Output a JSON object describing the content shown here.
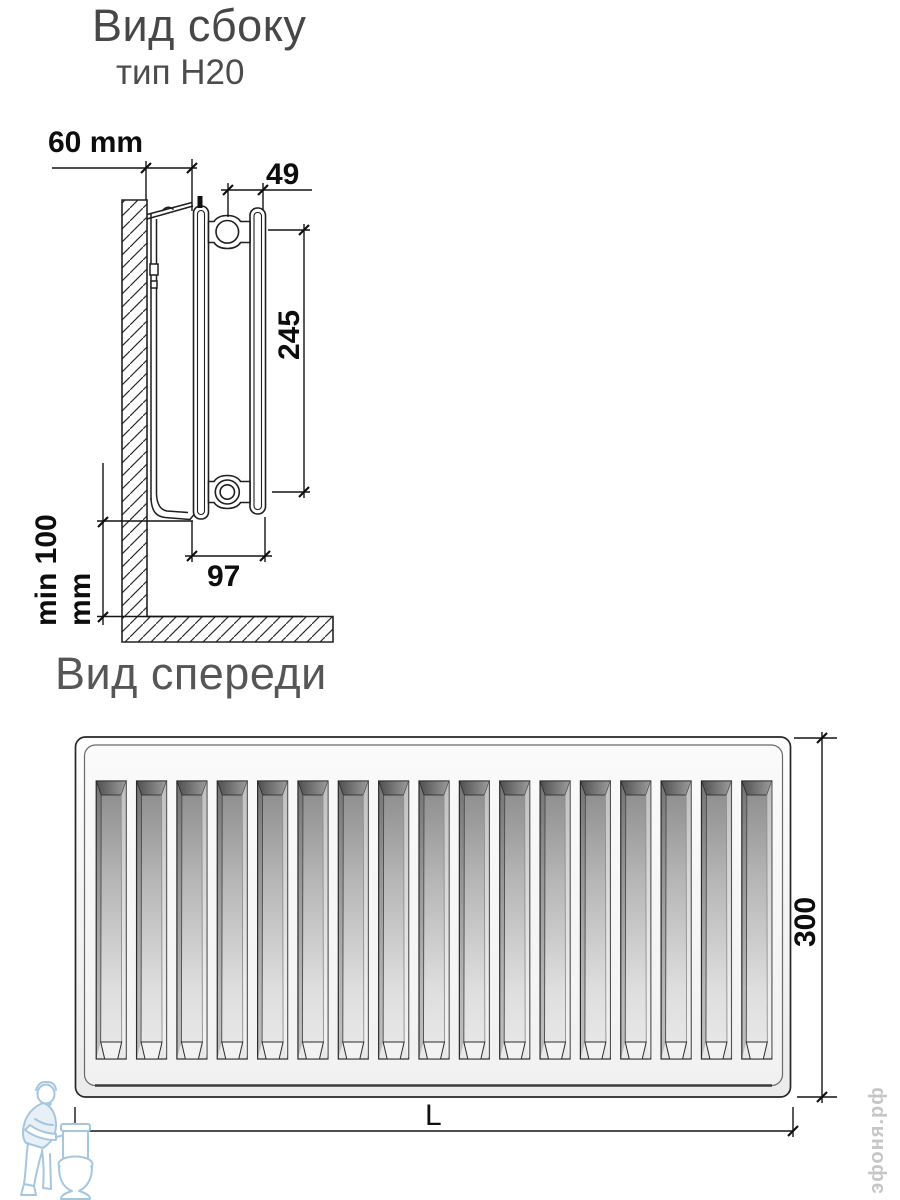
{
  "side_view": {
    "title": "Вид сбоку",
    "subtitle": "тип H20",
    "dimensions": {
      "wall_offset": "60 mm",
      "panel_pitch": "49",
      "bracket_span": "245",
      "floor_clearance": "min 100 mm",
      "depth": "97"
    }
  },
  "front_view": {
    "title": "Вид спереди",
    "dimensions": {
      "height": "300",
      "length": "L"
    },
    "num_channels": 17
  },
  "watermarks": {
    "site": "эфоня.рф",
    "plumber_icon": "plumber-with-toilet-icon"
  },
  "colors": {
    "line": "#1f1f1f",
    "title_gray": "#4c4c4c",
    "watermark_blue": "#a6c6de",
    "watermark_gray": "#c6c6c6"
  }
}
